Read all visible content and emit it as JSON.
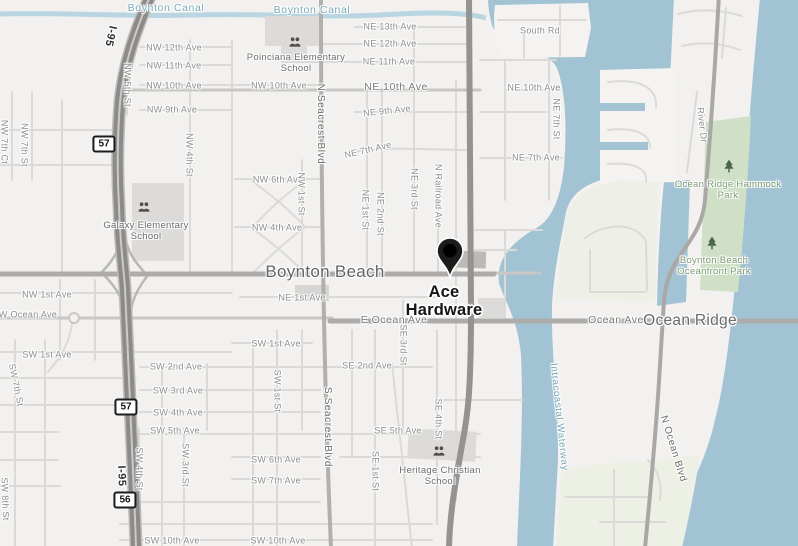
{
  "view": {
    "width": 798,
    "height": 546
  },
  "map": {
    "marker": {
      "name": "Ace Hardware"
    },
    "city": "Boynton Beach",
    "town": "Ocean Ridge",
    "colors": {
      "land": "#f2f1ef",
      "water": "#a2c3d4",
      "canal": "#b9d5e2",
      "park": "#cfe0c6",
      "park_label": "#7f9b74",
      "water_label": "#76a5b6",
      "road_major": "#adacaa",
      "road_minor": "#dbdad8",
      "highway": "#8c8b89",
      "marker_pin": "#1d1c1b"
    },
    "shields": [
      {
        "text": "57",
        "x": 104,
        "y": 144
      },
      {
        "text": "57",
        "x": 126,
        "y": 407
      },
      {
        "text": "56",
        "x": 125,
        "y": 500
      }
    ],
    "icons": [
      {
        "type": "school",
        "x": 295,
        "y": 42
      },
      {
        "type": "school",
        "x": 144,
        "y": 207
      },
      {
        "type": "school",
        "x": 439,
        "y": 451
      },
      {
        "type": "tree",
        "x": 729,
        "y": 166
      },
      {
        "type": "tree",
        "x": 712,
        "y": 243
      }
    ],
    "labels": [
      {
        "text": "Boynton Canal",
        "x": 166,
        "y": 8,
        "rot": 0,
        "cls": "canal"
      },
      {
        "text": "Boynton Canal",
        "x": 312,
        "y": 10,
        "rot": 0,
        "cls": "canal"
      },
      {
        "text": "NW 12th Ave",
        "x": 174,
        "y": 48,
        "rot": 0,
        "cls": "st"
      },
      {
        "text": "NW 11th Ave",
        "x": 174,
        "y": 66,
        "rot": 0,
        "cls": "st"
      },
      {
        "text": "NW 10th Ave",
        "x": 174,
        "y": 86,
        "rot": 0,
        "cls": "st"
      },
      {
        "text": "NW 10th Ave",
        "x": 279,
        "y": 86,
        "rot": 0,
        "cls": "st"
      },
      {
        "text": "NW 9th Ave",
        "x": 172,
        "y": 110,
        "rot": 0,
        "cls": "st"
      },
      {
        "text": "NE 13th Ave",
        "x": 390,
        "y": 27,
        "rot": 0,
        "cls": "st"
      },
      {
        "text": "NE 12th Ave",
        "x": 390,
        "y": 44,
        "rot": 0,
        "cls": "st"
      },
      {
        "text": "NE 11th Ave",
        "x": 389,
        "y": 62,
        "rot": 0,
        "cls": "st"
      },
      {
        "text": "NE 10th Ave",
        "x": 396,
        "y": 87,
        "rot": 0,
        "cls": "st-lg"
      },
      {
        "text": "NE 9th Ave",
        "x": 387,
        "y": 111,
        "rot": -6,
        "cls": "st"
      },
      {
        "text": "NE 7th Ave",
        "x": 368,
        "y": 150,
        "rot": -13,
        "cls": "st"
      },
      {
        "text": "NE 10th Ave",
        "x": 534,
        "y": 88,
        "rot": 0,
        "cls": "st"
      },
      {
        "text": "NE 7th Ave",
        "x": 536,
        "y": 158,
        "rot": 0,
        "cls": "st"
      },
      {
        "text": "South Rd",
        "x": 540,
        "y": 31,
        "rot": 0,
        "cls": "st"
      },
      {
        "text": "NW 6th Ave",
        "x": 278,
        "y": 180,
        "rot": 0,
        "cls": "st"
      },
      {
        "text": "NW 4th Ave",
        "x": 277,
        "y": 228,
        "rot": 0,
        "cls": "st"
      },
      {
        "text": "NW 1st Ave",
        "x": 47,
        "y": 295,
        "rot": 0,
        "cls": "st"
      },
      {
        "text": "NE 1st Ave",
        "x": 302,
        "y": 298,
        "rot": 0,
        "cls": "st"
      },
      {
        "text": "W Ocean Ave",
        "x": 28,
        "y": 315,
        "rot": 0,
        "cls": "st"
      },
      {
        "text": "E Ocean Ave",
        "x": 394,
        "y": 320,
        "rot": 0,
        "cls": "st-lg"
      },
      {
        "text": "Ocean Ave",
        "x": 616,
        "y": 320,
        "rot": 0,
        "cls": "st-lg"
      },
      {
        "text": "SW 1st Ave",
        "x": 47,
        "y": 355,
        "rot": 0,
        "cls": "st"
      },
      {
        "text": "SW 1st Ave",
        "x": 276,
        "y": 344,
        "rot": 0,
        "cls": "st"
      },
      {
        "text": "SW 2nd Ave",
        "x": 176,
        "y": 367,
        "rot": 0,
        "cls": "st"
      },
      {
        "text": "SW 3rd Ave",
        "x": 178,
        "y": 391,
        "rot": 0,
        "cls": "st"
      },
      {
        "text": "SW 4th Ave",
        "x": 178,
        "y": 413,
        "rot": 0,
        "cls": "st"
      },
      {
        "text": "SW 5th Ave",
        "x": 175,
        "y": 431,
        "rot": 0,
        "cls": "st"
      },
      {
        "text": "SE 2nd Ave",
        "x": 367,
        "y": 366,
        "rot": 0,
        "cls": "st"
      },
      {
        "text": "SE 5th Ave",
        "x": 398,
        "y": 431,
        "rot": 0,
        "cls": "st"
      },
      {
        "text": "SW 6th Ave",
        "x": 276,
        "y": 460,
        "rot": 0,
        "cls": "st"
      },
      {
        "text": "SW 7th Ave",
        "x": 276,
        "y": 481,
        "rot": 0,
        "cls": "st"
      },
      {
        "text": "SW 10th Ave",
        "x": 172,
        "y": 541,
        "rot": 0,
        "cls": "st"
      },
      {
        "text": "SW 10th Ave",
        "x": 278,
        "y": 541,
        "rot": 0,
        "cls": "st"
      },
      {
        "text": "NW 7th Ct",
        "x": 4,
        "y": 142,
        "rot": 90,
        "cls": "vst"
      },
      {
        "text": "NW 7th St",
        "x": 24,
        "y": 145,
        "rot": 90,
        "cls": "vst"
      },
      {
        "text": "NW 5th St",
        "x": 127,
        "y": 85,
        "rot": 90,
        "cls": "vst"
      },
      {
        "text": "NW 4th St",
        "x": 189,
        "y": 155,
        "rot": 90,
        "cls": "vst"
      },
      {
        "text": "NW 1st St",
        "x": 301,
        "y": 194,
        "rot": 90,
        "cls": "vst"
      },
      {
        "text": "NE 1st St",
        "x": 365,
        "y": 210,
        "rot": 90,
        "cls": "vst"
      },
      {
        "text": "NE 2nd St",
        "x": 380,
        "y": 214,
        "rot": 90,
        "cls": "vst"
      },
      {
        "text": "NE 3rd St",
        "x": 414,
        "y": 189,
        "rot": 90,
        "cls": "vst"
      },
      {
        "text": "N Railroad Ave",
        "x": 438,
        "y": 196,
        "rot": 90,
        "cls": "vst"
      },
      {
        "text": "NE 7th St",
        "x": 556,
        "y": 119,
        "rot": 90,
        "cls": "vst"
      },
      {
        "text": "N Seacrest Blvd",
        "x": 320,
        "y": 124,
        "rot": 90,
        "cls": "vst-lg"
      },
      {
        "text": "S Seacrest Blvd",
        "x": 327,
        "y": 427,
        "rot": 90,
        "cls": "vst-lg"
      },
      {
        "text": "SW 1st St",
        "x": 277,
        "y": 391,
        "rot": 90,
        "cls": "vst"
      },
      {
        "text": "SE 1st St",
        "x": 375,
        "y": 471,
        "rot": 90,
        "cls": "vst"
      },
      {
        "text": "SE 3rd St",
        "x": 403,
        "y": 345,
        "rot": 90,
        "cls": "vst"
      },
      {
        "text": "SE 4th St",
        "x": 438,
        "y": 419,
        "rot": 90,
        "cls": "vst"
      },
      {
        "text": "SW 4th St",
        "x": 139,
        "y": 469,
        "rot": 90,
        "cls": "vst"
      },
      {
        "text": "SW 3rd St",
        "x": 185,
        "y": 465,
        "rot": 90,
        "cls": "vst"
      },
      {
        "text": "SW 7th St",
        "x": 16,
        "y": 385,
        "rot": 78,
        "cls": "vst"
      },
      {
        "text": "SW 8th St",
        "x": 5,
        "y": 499,
        "rot": 88,
        "cls": "vst"
      },
      {
        "text": "River Dr",
        "x": 702,
        "y": 125,
        "rot": 84,
        "cls": "vst"
      },
      {
        "text": "N Ocean Blvd",
        "x": 673,
        "y": 449,
        "rot": 73,
        "cls": "vst-lg"
      },
      {
        "text": "Intracoastal Waterway",
        "x": 559,
        "y": 417,
        "rot": 84,
        "cls": "waterway"
      },
      {
        "text": "I-95",
        "x": 110,
        "y": 36,
        "rot": 102,
        "cls": "hwy"
      },
      {
        "text": "I-95",
        "x": 121,
        "y": 476,
        "rot": 88,
        "cls": "hwy"
      },
      {
        "text": "Boynton Beach",
        "x": 325,
        "y": 272,
        "rot": 0,
        "cls": "city"
      },
      {
        "text": "Ocean Ridge",
        "x": 690,
        "y": 321,
        "rot": 0,
        "cls": "town"
      },
      {
        "text": "Poinciana Elementary School",
        "x": 296,
        "y": 63,
        "rot": 0,
        "cls": "school"
      },
      {
        "text": "Galaxy Elementary School",
        "x": 146,
        "y": 231,
        "rot": 0,
        "cls": "school"
      },
      {
        "text": "Heritage Christian School",
        "x": 440,
        "y": 476,
        "rot": 0,
        "cls": "school"
      },
      {
        "text": "Ocean Ridge Hammock Park",
        "x": 728,
        "y": 190,
        "rot": 0,
        "cls": "park"
      },
      {
        "text": "Boynton Beach Oceanfront Park",
        "x": 714,
        "y": 266,
        "rot": 0,
        "cls": "park"
      }
    ]
  }
}
